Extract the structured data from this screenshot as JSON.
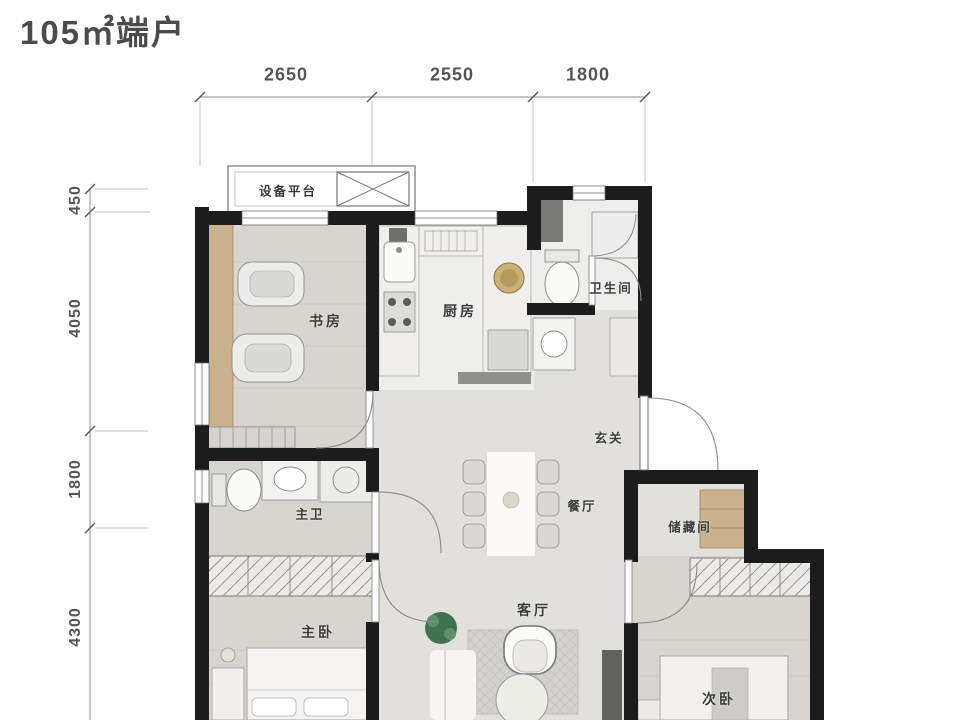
{
  "title": "105㎡端户",
  "dimensions": {
    "top": [
      "2650",
      "2550",
      "1800"
    ],
    "left": [
      "450",
      "4050",
      "1800",
      "4300"
    ]
  },
  "rooms": {
    "equipment_platform": "设备平台",
    "study": "书房",
    "kitchen": "厨房",
    "bathroom": "卫生间",
    "entry": "玄关",
    "master_bath": "主卫",
    "dining": "餐厅",
    "storage": "储藏间",
    "master_bedroom": "主卧",
    "living": "客厅",
    "second_bedroom": "次卧"
  },
  "colors": {
    "wall": "#1c1c1c",
    "floor": "#e1e0dc",
    "floorwood": "#d8d5d0",
    "floortile": "#eeeeec",
    "wood": "#c9b18e",
    "plant": "#41724f",
    "dim": "#8a8a8a",
    "text": "#3a3a3a"
  }
}
